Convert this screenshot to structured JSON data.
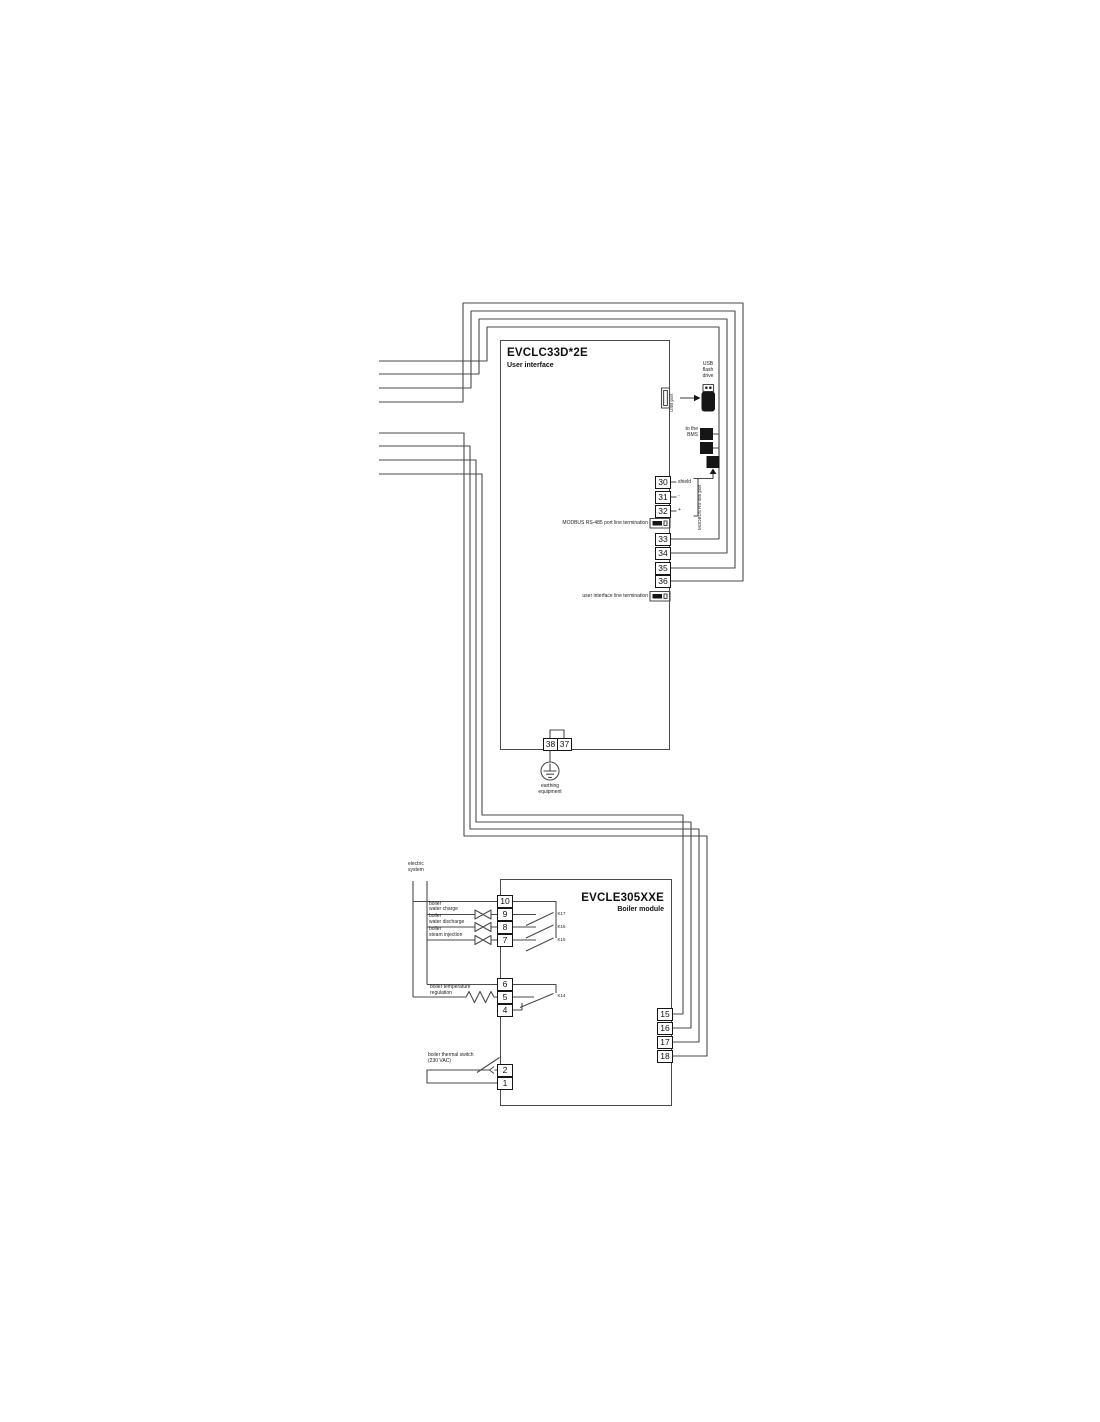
{
  "diagram": {
    "user_interface_module": {
      "title": "EVCLC33D*2E",
      "subtitle": "User interface",
      "usb_port_label": "USB port",
      "usb_flash_drive_label": "USB\nflash\ndrive",
      "bms_label": "to the\nBMS",
      "modbus_port_label": "MODBUS RS-485 port",
      "terminal_30_label": "shield",
      "terminal_31_label": "-",
      "terminal_32_label": "+",
      "modbus_termination_label": "MODBUS RS-485 port line termination",
      "ui_termination_label": "user interface line termination",
      "right_terminals": [
        "30",
        "31",
        "32",
        "33",
        "34",
        "35",
        "36"
      ],
      "bottom_terminals": [
        "38",
        "37"
      ],
      "earthing_label": "earthing\nequipment"
    },
    "boiler_module": {
      "title": "EVCLE305XXE",
      "subtitle": "Boiler module",
      "electric_system_label": "electric\nsystem",
      "water_charge_label": "boiler\nwater charge",
      "water_discharge_label": "boiler\nwater discharge",
      "steam_injection_label": "boiler\nsteam injection",
      "temp_regulation_label": "boiler temperature\nregulation",
      "thermal_switch_label": "boiler thermal switch\n(230 VAC)",
      "relays": [
        "K17",
        "K16",
        "K15",
        "K14"
      ],
      "left_terminals_relay": [
        "10",
        "9",
        "8",
        "7"
      ],
      "left_terminals_temp": [
        "6",
        "5",
        "4"
      ],
      "left_terminals_thermal": [
        "2",
        "1"
      ],
      "right_terminals": [
        "15",
        "16",
        "17",
        "18"
      ]
    }
  }
}
